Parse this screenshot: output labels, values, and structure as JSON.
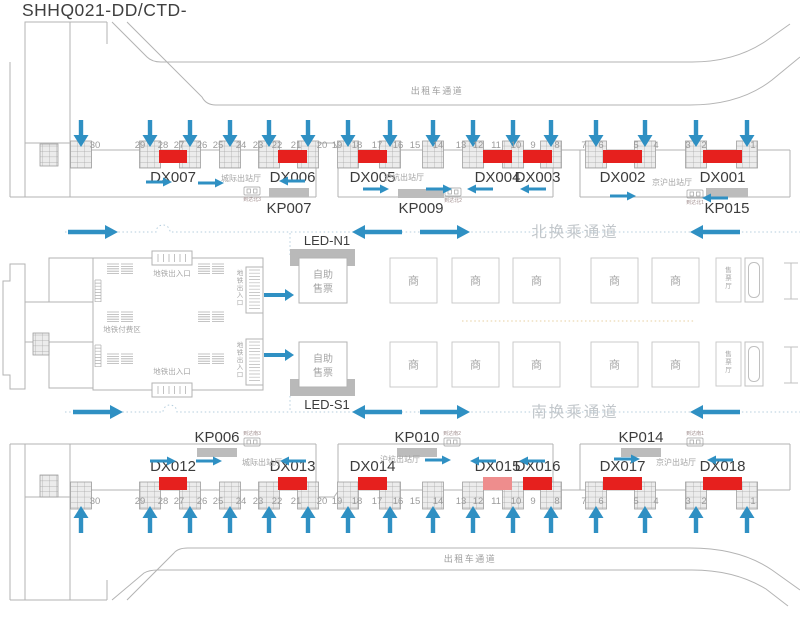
{
  "title": "SHHQ021-DD/CTD-",
  "colors": {
    "red": "#e6201e",
    "red_light": "#ee8d8d",
    "blue": "#2f90c3",
    "line": "#b3b3b3",
    "bar": "#bcbcbc",
    "dark": "#3c3c3c",
    "gray": "#9b9b9b",
    "light": "#a5a5a5"
  },
  "labels": {
    "taxi_lane": "出租车通道",
    "north_passage": "北换乘通道",
    "south_passage": "南换乘通道",
    "led_north": "LED-N1",
    "led_south": "LED-S1",
    "self_ticketing_lines": [
      "自助",
      "售票"
    ],
    "shop": "商",
    "ticket_hall": "售票厅",
    "metro_entrance": "地铁出入口",
    "metro_paid_area": "地铁付费区"
  },
  "gates": {
    "numbers": [
      "30",
      "29",
      "28",
      "27",
      "26",
      "25",
      "24",
      "23",
      "22",
      "21",
      "20",
      "19",
      "18",
      "17",
      "16",
      "15",
      "14",
      "13",
      "12",
      "11",
      "10",
      "9",
      "8",
      "7",
      "6",
      "5",
      "4",
      "3",
      "2",
      "1"
    ],
    "x": [
      95,
      140,
      163,
      179,
      202,
      218,
      241,
      258,
      277,
      296,
      322,
      337,
      357,
      377,
      398,
      415,
      438,
      461,
      478,
      496,
      516,
      533,
      557,
      584,
      601,
      636,
      656,
      688,
      704,
      753
    ],
    "y_top": 148,
    "y_bottom": 504
  },
  "pillars": {
    "x": [
      81,
      150,
      190,
      230,
      269,
      308,
      348,
      390,
      433,
      473,
      513,
      551,
      596,
      645,
      696,
      747
    ],
    "y_top": 141,
    "y_bottom": 482
  },
  "panels_top": [
    {
      "id": "DX007",
      "x": 159,
      "w": 28
    },
    {
      "id": "DX006",
      "x": 278,
      "w": 29
    },
    {
      "id": "DX005",
      "x": 358,
      "w": 29
    },
    {
      "id": "DX004",
      "x": 483,
      "w": 29
    },
    {
      "id": "DX003",
      "x": 523,
      "w": 29
    },
    {
      "id": "DX002",
      "x": 603,
      "w": 39
    },
    {
      "id": "DX001",
      "x": 703,
      "w": 39
    }
  ],
  "panels_bottom": [
    {
      "id": "DX012",
      "x": 159,
      "w": 28
    },
    {
      "id": "DX013",
      "x": 278,
      "w": 29
    },
    {
      "id": "DX014",
      "x": 358,
      "w": 29
    },
    {
      "id": "DX015",
      "x": 483,
      "w": 29,
      "variant": "light"
    },
    {
      "id": "DX016",
      "x": 523,
      "w": 29
    },
    {
      "id": "DX017",
      "x": 603,
      "w": 39
    },
    {
      "id": "DX018",
      "x": 703,
      "w": 39
    }
  ],
  "kp_top": [
    {
      "id": "KP007",
      "bar": [
        269,
        188,
        40,
        9
      ],
      "label_x": 289,
      "label_y": 213
    },
    {
      "id": "KP009",
      "bar": [
        398,
        189,
        46,
        9
      ],
      "label_x": 421,
      "label_y": 213
    },
    {
      "id": "KP015",
      "bar": [
        706,
        188,
        42,
        9
      ],
      "label_x": 727,
      "label_y": 213
    }
  ],
  "kp_bottom": [
    {
      "id": "KP006",
      "bar": [
        197,
        448,
        40,
        9
      ],
      "label_x": 217,
      "label_y": 442
    },
    {
      "id": "KP010",
      "bar": [
        397,
        448,
        40,
        9
      ],
      "label_x": 417,
      "label_y": 442
    },
    {
      "id": "KP014",
      "bar": [
        621,
        448,
        40,
        9
      ],
      "label_x": 641,
      "label_y": 442
    }
  ],
  "arrivals_top": [
    {
      "id": "到达北3",
      "x": 252,
      "icon_y": 187
    },
    {
      "id": "到达北2",
      "x": 453,
      "icon_y": 188
    },
    {
      "id": "到达北1",
      "x": 695,
      "icon_y": 190
    }
  ],
  "arrivals_bottom": [
    {
      "id": "到达南3",
      "x": 252,
      "icon_y": 438
    },
    {
      "id": "到达南2",
      "x": 452,
      "icon_y": 438
    },
    {
      "id": "到达南1",
      "x": 695,
      "icon_y": 438
    }
  ],
  "hall_labels_top": [
    {
      "label": "城际出站厅",
      "x": 241,
      "y": 181
    },
    {
      "label": "沪杭出站厅",
      "x": 404,
      "y": 180
    },
    {
      "label": "京沪出站厅",
      "x": 672,
      "y": 185
    }
  ],
  "hall_labels_bottom": [
    {
      "label": "城际出站厅",
      "x": 262,
      "y": 465
    },
    {
      "label": "沪杭出站厅",
      "x": 400,
      "y": 462
    },
    {
      "label": "京沪出站厅",
      "x": 676,
      "y": 465
    }
  ],
  "hall_arrows_top": [
    {
      "x": 146,
      "y": 182,
      "dir": "r"
    },
    {
      "x": 198,
      "y": 183,
      "dir": "r"
    },
    {
      "x": 279,
      "y": 181,
      "dir": "l"
    },
    {
      "x": 363,
      "y": 189,
      "dir": "r"
    },
    {
      "x": 426,
      "y": 189,
      "dir": "r"
    },
    {
      "x": 467,
      "y": 189,
      "dir": "l"
    },
    {
      "x": 520,
      "y": 189,
      "dir": "l"
    },
    {
      "x": 610,
      "y": 196,
      "dir": "r"
    },
    {
      "x": 702,
      "y": 198,
      "dir": "l"
    }
  ],
  "hall_arrows_bottom": [
    {
      "x": 150,
      "y": 461,
      "dir": "r"
    },
    {
      "x": 196,
      "y": 461,
      "dir": "r"
    },
    {
      "x": 280,
      "y": 461,
      "dir": "l"
    },
    {
      "x": 425,
      "y": 460,
      "dir": "r"
    },
    {
      "x": 470,
      "y": 461,
      "dir": "l"
    },
    {
      "x": 519,
      "y": 461,
      "dir": "l"
    },
    {
      "x": 614,
      "y": 459,
      "dir": "r"
    },
    {
      "x": 707,
      "y": 460,
      "dir": "l"
    }
  ],
  "passage_arrows_north": [
    {
      "x": 68,
      "dir": "r"
    },
    {
      "x": 352,
      "dir": "l"
    },
    {
      "x": 420,
      "dir": "r"
    },
    {
      "x": 690,
      "dir": "l"
    }
  ],
  "passage_arrows_south": [
    {
      "x": 73,
      "dir": "r"
    },
    {
      "x": 352,
      "dir": "l"
    },
    {
      "x": 420,
      "dir": "r"
    },
    {
      "x": 690,
      "dir": "l"
    }
  ],
  "metro_arrows": [
    {
      "x": 264,
      "y": 295
    },
    {
      "x": 264,
      "y": 355
    }
  ],
  "shops": {
    "xs": [
      390,
      452,
      513,
      591,
      652
    ],
    "rows_y": [
      258,
      342
    ],
    "w": 47,
    "h": 45
  },
  "ticket_halls": {
    "x": 716,
    "w": 25,
    "rows_y": [
      258,
      342
    ],
    "h": 44
  },
  "escalator_hatches": [
    [
      107,
      264
    ],
    [
      198,
      264
    ],
    [
      107,
      312
    ],
    [
      198,
      312
    ],
    [
      107,
      354
    ],
    [
      198,
      354
    ]
  ],
  "ladders": [
    [
      95,
      280
    ],
    [
      95,
      345
    ]
  ],
  "metro_side_boxes_y": [
    267,
    339
  ]
}
